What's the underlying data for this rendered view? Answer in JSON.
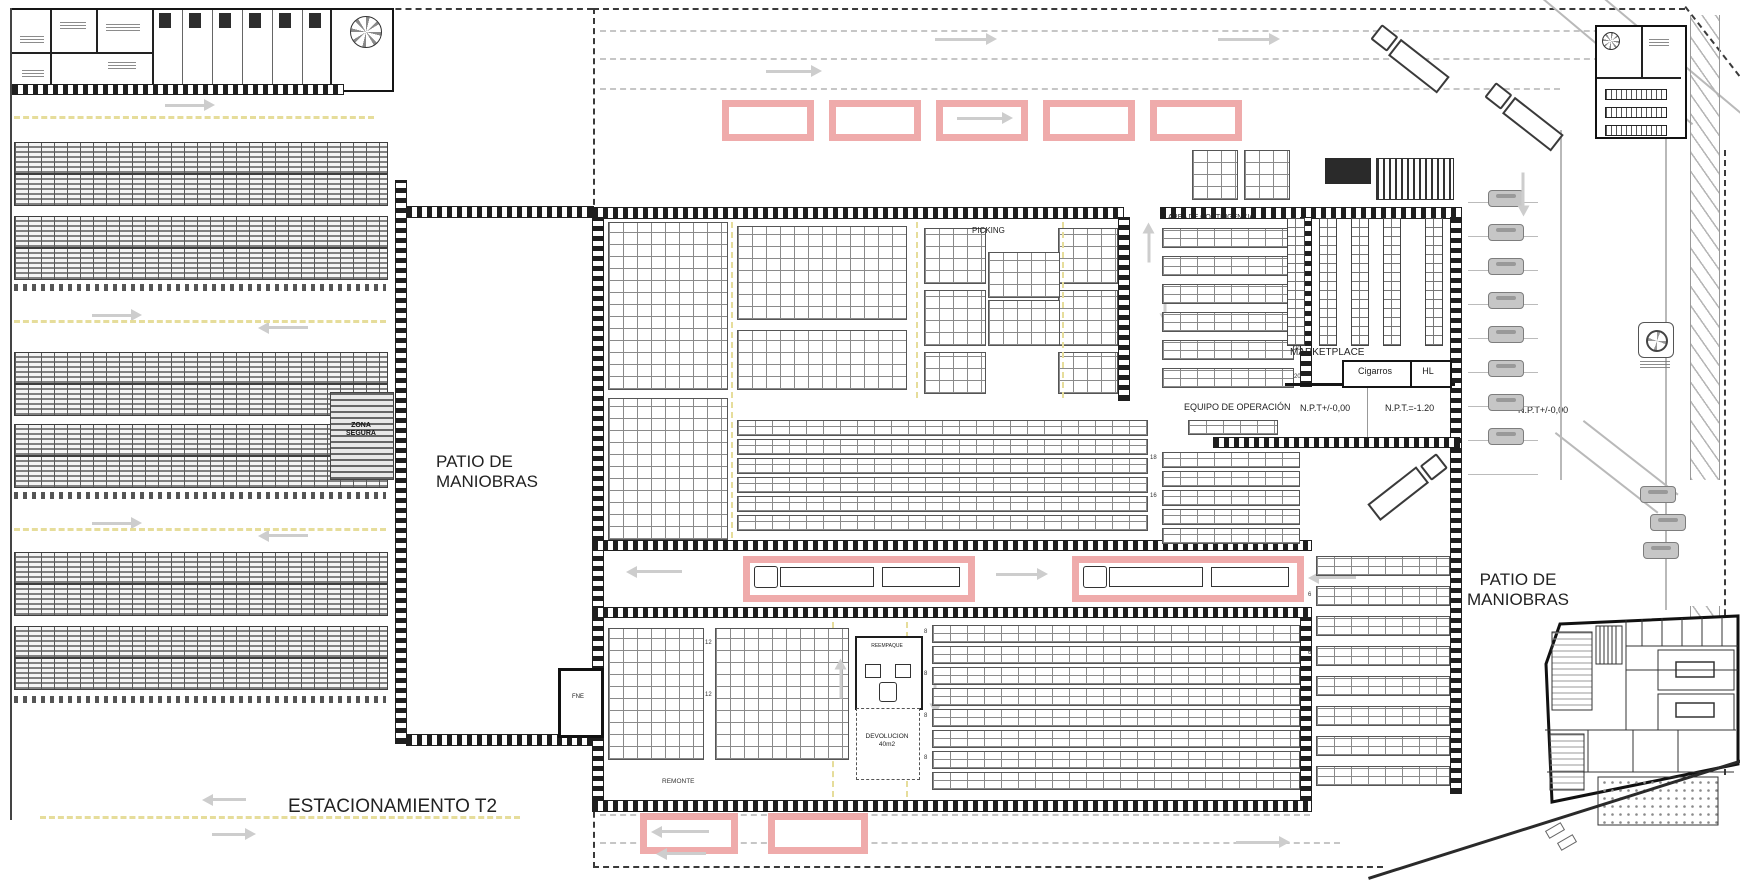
{
  "labels": {
    "patio_maniobras_left": "PATIO DE\nMANIOBRAS",
    "patio_maniobras_right": "PATIO DE\nMANIOBRAS",
    "estacionamiento": "ESTACIONAMIENTO T2",
    "picking": "PICKING",
    "area_contingencia": "AREA DE CONTINGENCIA",
    "marketplace": "MARKETPLACE",
    "cigarros": "Cigarros",
    "hl": "HL",
    "equipo_operacion": "EQUIPO DE OPERACIÓN",
    "npt_zone1": "N.P.T+/-0,00",
    "npt_zone2": "N.P.T.=-1.20",
    "npt_zone3": "N.P.T+/-0,00",
    "zona_segura": "ZONA\nSEGURA",
    "reempaque": "REEMPAQUE",
    "devolucion": "DEVOLUCION\n40m2",
    "remonte": "REMONTE",
    "fne": "FNE"
  },
  "rack_numbers": {
    "n20": "20",
    "n18": "18",
    "n16": "16",
    "n12": "12",
    "n8": "8",
    "n6": "6"
  },
  "colors": {
    "highlight_pink": "#efabab",
    "arrow_gray": "#cdcdcd",
    "lane_yellow": "#e6dd9b",
    "wall_dark": "#1f1f1f"
  }
}
